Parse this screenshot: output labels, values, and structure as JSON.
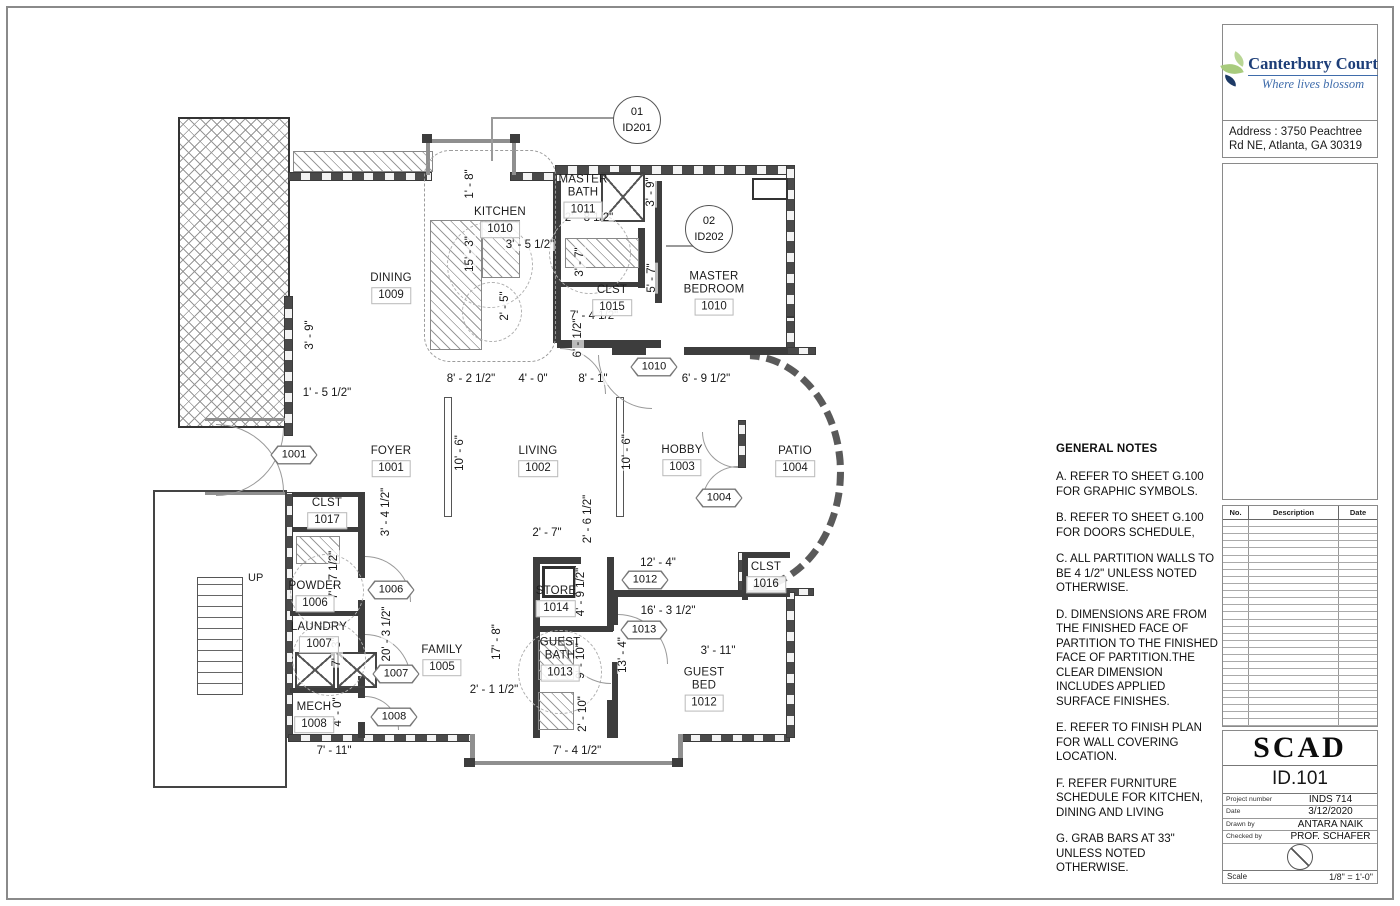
{
  "title_block": {
    "logo": {
      "name": "Canterbury Court",
      "tagline": "Where lives blossom"
    },
    "address": "Address : 3750 Peachtree Rd NE, Atlanta, GA 30319",
    "revision_table": {
      "headers": [
        "No.",
        "Description",
        "Date"
      ],
      "empty_rows": 29
    },
    "school": "SCAD",
    "sheet_number": "ID.101",
    "fields": [
      {
        "label": "Project number",
        "value": "INDS 714"
      },
      {
        "label": "Date",
        "value": "3/12/2020"
      },
      {
        "label": "Drawn by",
        "value": "ANTARA NAIK"
      },
      {
        "label": "Checked by",
        "value": "PROF. SCHAFER"
      }
    ],
    "scale_label": "Scale",
    "scale_value": "1/8\" = 1'-0\""
  },
  "general_notes": {
    "title": "GENERAL NOTES",
    "notes": [
      "A. REFER TO SHEET G.100 FOR GRAPHIC SYMBOLS.",
      "B. REFER TO SHEET G.100 FOR DOORS SCHEDULE,",
      "C. ALL PARTITION WALLS TO BE 4 1/2\" UNLESS NOTED OTHERWISE.",
      "D. DIMENSIONS ARE FROM THE FINISHED FACE OF PARTITION TO THE FINISHED FACE OF PARTITION.THE CLEAR DIMENSION INCLUDES APPLIED SURFACE FINISHES.",
      "E. REFER TO FINISH PLAN FOR WALL COVERING LOCATION.",
      "F. REFER FURNITURE SCHEDULE FOR KITCHEN, DINING AND LIVING",
      "G. GRAB BARS AT 33\" UNLESS NOTED OTHERWISE."
    ]
  },
  "plan": {
    "up_label": {
      "text": "UP",
      "x": 248,
      "y": 572
    },
    "rooms": [
      {
        "lines": [
          "KITCHEN"
        ],
        "number": "1010",
        "x": 500,
        "y": 222
      },
      {
        "lines": [
          "MASTER",
          "BATH"
        ],
        "number": "1011",
        "x": 583,
        "y": 196
      },
      {
        "lines": [
          "DINING"
        ],
        "number": "1009",
        "x": 391,
        "y": 288
      },
      {
        "lines": [
          "MASTER",
          "BEDROOM"
        ],
        "number": "1010",
        "x": 714,
        "y": 293
      },
      {
        "lines": [
          "CLST"
        ],
        "number": "1015",
        "x": 612,
        "y": 300
      },
      {
        "lines": [
          "FOYER"
        ],
        "number": "1001",
        "x": 391,
        "y": 461
      },
      {
        "lines": [
          "LIVING"
        ],
        "number": "1002",
        "x": 538,
        "y": 461
      },
      {
        "lines": [
          "HOBBY"
        ],
        "number": "1003",
        "x": 682,
        "y": 460
      },
      {
        "lines": [
          "PATIO"
        ],
        "number": "1004",
        "x": 795,
        "y": 461
      },
      {
        "lines": [
          "CLST"
        ],
        "number": "1017",
        "x": 327,
        "y": 513
      },
      {
        "lines": [
          "POWDER"
        ],
        "number": "1006",
        "x": 315,
        "y": 596
      },
      {
        "lines": [
          "LAUNDRY"
        ],
        "number": "1007",
        "x": 319,
        "y": 637
      },
      {
        "lines": [
          "FAMILY"
        ],
        "number": "1005",
        "x": 442,
        "y": 660
      },
      {
        "lines": [
          "MECH"
        ],
        "number": "1008",
        "x": 314,
        "y": 717
      },
      {
        "lines": [
          "STORE"
        ],
        "number": "1014",
        "x": 556,
        "y": 601
      },
      {
        "lines": [
          "GUEST",
          "BATH"
        ],
        "number": "1013",
        "x": 560,
        "y": 659
      },
      {
        "lines": [
          "GUEST",
          "BED"
        ],
        "number": "1012",
        "x": 704,
        "y": 689
      },
      {
        "lines": [
          "CLST"
        ],
        "number": "1016",
        "x": 766,
        "y": 577
      }
    ],
    "dimensions": [
      {
        "t": "1' - 5 1/2\"",
        "x": 327,
        "y": 393,
        "v": false
      },
      {
        "t": "8' - 2 1/2\"",
        "x": 471,
        "y": 379,
        "v": false
      },
      {
        "t": "4' - 0\"",
        "x": 533,
        "y": 379,
        "v": false
      },
      {
        "t": "8' - 1\"",
        "x": 593,
        "y": 379,
        "v": false
      },
      {
        "t": "6' - 9 1/2\"",
        "x": 706,
        "y": 379,
        "v": false
      },
      {
        "t": "3' - 5 1/2\"",
        "x": 530,
        "y": 245,
        "v": false
      },
      {
        "t": "2' - 8 1/2\"",
        "x": 589,
        "y": 218,
        "v": false
      },
      {
        "t": "7' - 4 1/2\"",
        "x": 594,
        "y": 316,
        "v": false
      },
      {
        "t": "2' - 7\"",
        "x": 547,
        "y": 533,
        "v": false
      },
      {
        "t": "12' - 4\"",
        "x": 658,
        "y": 563,
        "v": false
      },
      {
        "t": "16' - 3 1/2\"",
        "x": 668,
        "y": 611,
        "v": false
      },
      {
        "t": "3' - 11\"",
        "x": 718,
        "y": 651,
        "v": false
      },
      {
        "t": "2' - 1 1/2\"",
        "x": 494,
        "y": 690,
        "v": false
      },
      {
        "t": "7' - 11\"",
        "x": 334,
        "y": 751,
        "v": false
      },
      {
        "t": "7' - 4 1/2\"",
        "x": 577,
        "y": 751,
        "v": false
      },
      {
        "t": "1' - 8\"",
        "x": 470,
        "y": 184,
        "v": true
      },
      {
        "t": "3' - 9\"",
        "x": 310,
        "y": 335,
        "v": true
      },
      {
        "t": "15' - 3\"",
        "x": 470,
        "y": 254,
        "v": true
      },
      {
        "t": "2' - 5\"",
        "x": 505,
        "y": 306,
        "v": true
      },
      {
        "t": "3' - 7\"",
        "x": 580,
        "y": 262,
        "v": true
      },
      {
        "t": "3' - 9\"",
        "x": 651,
        "y": 192,
        "v": true
      },
      {
        "t": "5' - 7\"",
        "x": 652,
        "y": 278,
        "v": true
      },
      {
        "t": "6' - 1/2\"",
        "x": 578,
        "y": 338,
        "v": true
      },
      {
        "t": "10' - 6\"",
        "x": 460,
        "y": 453,
        "v": true
      },
      {
        "t": "10' - 6\"",
        "x": 627,
        "y": 452,
        "v": true
      },
      {
        "t": "3' - 4 1/2\"",
        "x": 386,
        "y": 512,
        "v": true
      },
      {
        "t": "2' - 6 1/2\"",
        "x": 588,
        "y": 519,
        "v": true
      },
      {
        "t": "7' - 7 1/2\"",
        "x": 334,
        "y": 575,
        "v": true
      },
      {
        "t": "7' - 3\"",
        "x": 337,
        "y": 652,
        "v": true
      },
      {
        "t": "20' - 3 1/2\"",
        "x": 387,
        "y": 634,
        "v": true
      },
      {
        "t": "17' - 8\"",
        "x": 497,
        "y": 642,
        "v": true
      },
      {
        "t": "4' - 9 1/2\"",
        "x": 581,
        "y": 592,
        "v": true
      },
      {
        "t": "9' - 10\"",
        "x": 581,
        "y": 661,
        "v": true
      },
      {
        "t": "2' - 10\"",
        "x": 583,
        "y": 714,
        "v": true
      },
      {
        "t": "13' - 4\"",
        "x": 623,
        "y": 655,
        "v": true
      },
      {
        "t": "4' - 0\"",
        "x": 338,
        "y": 712,
        "v": true
      }
    ],
    "door_tags": [
      {
        "number": "1001",
        "x": 294,
        "y": 455
      },
      {
        "number": "1010",
        "x": 654,
        "y": 367
      },
      {
        "number": "1004",
        "x": 719,
        "y": 498
      },
      {
        "number": "1006",
        "x": 391,
        "y": 590
      },
      {
        "number": "1007",
        "x": 396,
        "y": 674
      },
      {
        "number": "1008",
        "x": 394,
        "y": 717
      },
      {
        "number": "1012",
        "x": 645,
        "y": 580
      },
      {
        "number": "1013",
        "x": 644,
        "y": 630
      }
    ],
    "callouts": [
      {
        "num": "01",
        "id": "ID201",
        "x": 637,
        "y": 120
      },
      {
        "num": "02",
        "id": "ID202",
        "x": 709,
        "y": 229
      }
    ]
  }
}
